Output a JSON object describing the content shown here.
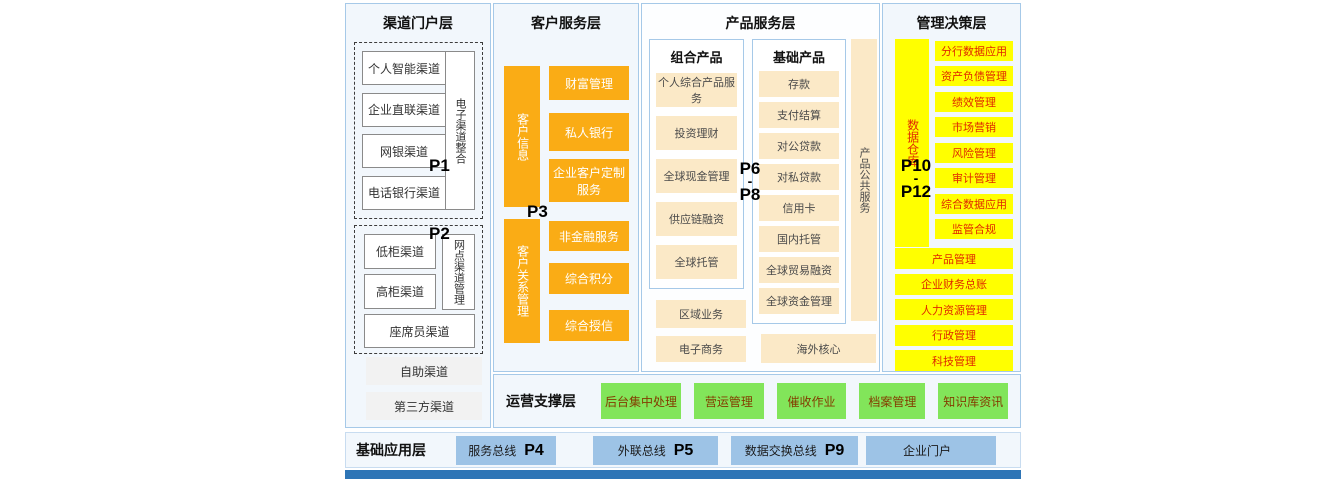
{
  "colors": {
    "orange": "#FAAC15",
    "cream": "#FBE9C7",
    "yellow": "#FFFF00",
    "green": "#82E55A",
    "light_blue": "#9DC3E6",
    "bottom_bar": "#2E75B6",
    "yellow_text_red": "#E02800",
    "panel_border": "#A6C9E8"
  },
  "channel": {
    "title": "渠道门户层",
    "p1": "P1",
    "p2": "P2",
    "group1_items": [
      "个人智能渠道",
      "企业直联渠道",
      "网银渠道",
      "电话银行渠道"
    ],
    "group1_vertical": "电子渠道整合",
    "group2_items": [
      "低柜渠道",
      "高柜渠道"
    ],
    "group2_vertical": "网点渠道管理",
    "group2_wide": "座席员渠道",
    "extra_items": [
      "自助渠道",
      "第三方渠道"
    ]
  },
  "customer": {
    "title": "客户服务层",
    "p3": "P3",
    "vertical_top": "客户信息",
    "vertical_bottom": "客户关系管理",
    "top_items": [
      "财富管理",
      "私人银行",
      "企业客户定制服务"
    ],
    "bottom_items": [
      "非金融服务",
      "综合积分",
      "综合授信"
    ]
  },
  "product": {
    "title": "产品服务层",
    "p6": "P6",
    "p_dash": "-",
    "p8": "P8",
    "combo_title": "组合产品",
    "combo_items": [
      "个人综合产品服务",
      "投资理财",
      "全球现金管理",
      "供应链融资",
      "全球托管"
    ],
    "basic_title": "基础产品",
    "basic_items": [
      "存款",
      "支付结算",
      "对公贷款",
      "对私贷款",
      "信用卡",
      "国内托管",
      "全球贸易融资",
      "全球资金管理"
    ],
    "vertical": "产品公共服务",
    "left_extra": [
      "区域业务",
      "电子商务"
    ],
    "right_extra": "海外核心"
  },
  "management": {
    "title": "管理决策层",
    "p10": "P10",
    "p_dash": "-",
    "p12": "P12",
    "vertical": "数据仓库",
    "items": [
      "分行数据应用",
      "资产负债管理",
      "绩效管理",
      "市场营销",
      "风险管理",
      "审计管理",
      "综合数据应用",
      "监管合规"
    ],
    "wide_items": [
      "产品管理",
      "企业财务总账",
      "人力资源管理",
      "行政管理",
      "科技管理"
    ]
  },
  "operation": {
    "title": "运营支撑层",
    "items": [
      "后台集中处理",
      "营运管理",
      "催收作业",
      "档案管理",
      "知识库资讯"
    ]
  },
  "foundation": {
    "title": "基础应用层",
    "boxes": [
      {
        "label": "服务总线",
        "p": "P4"
      },
      {
        "label": "外联总线",
        "p": "P5"
      },
      {
        "label": "数据交换总线",
        "p": "P9"
      },
      {
        "label": "企业门户",
        "p": ""
      }
    ]
  }
}
